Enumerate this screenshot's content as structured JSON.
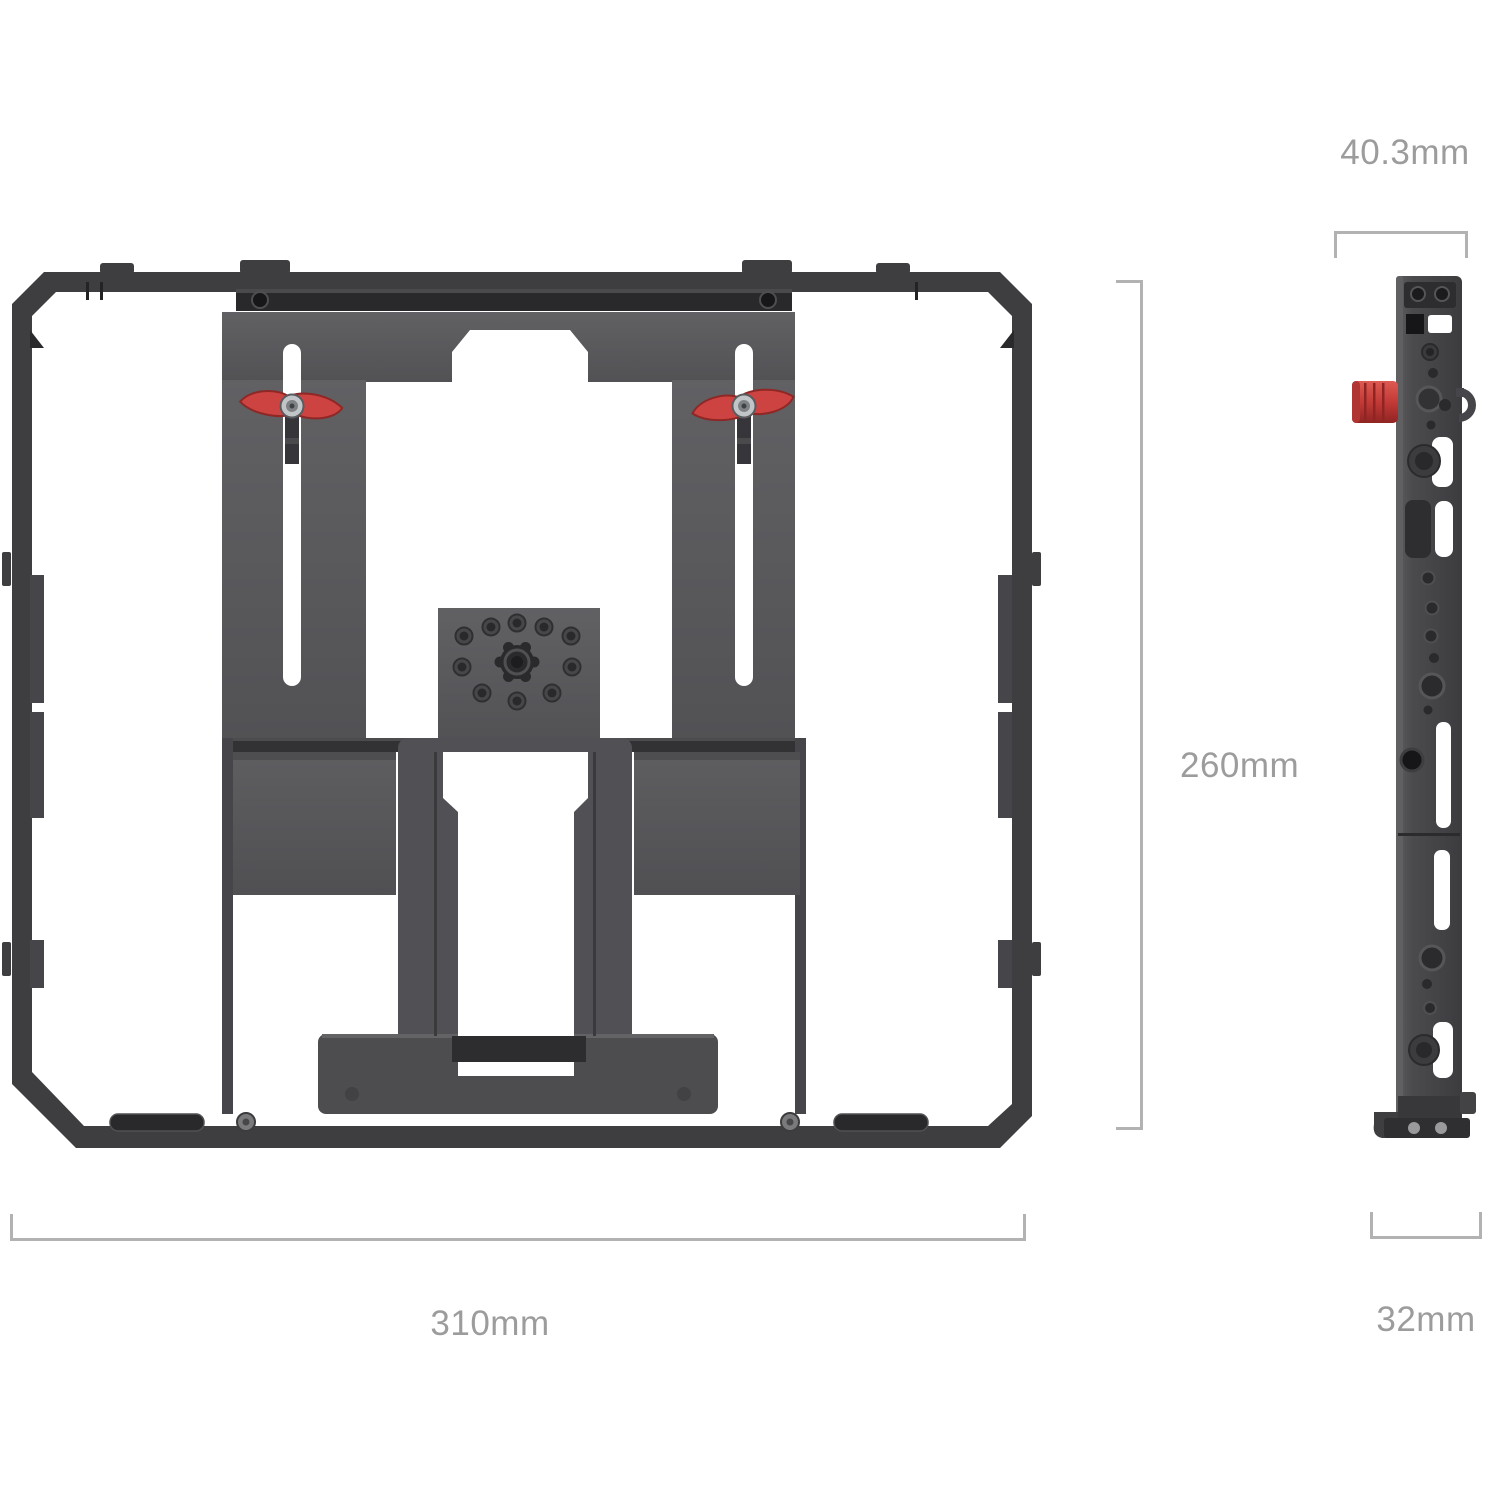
{
  "diagram": {
    "dimensions": {
      "front_width": "310mm",
      "front_height": "260mm",
      "side_top_width": "40.3mm",
      "side_bottom_width": "32mm"
    },
    "colors": {
      "background": "#ffffff",
      "cage_frame": "#3e3e41",
      "plate_gray": "#59595c",
      "panel_gray": "#56565a",
      "accent_red": "#cd4341",
      "knob_red": "#b23431",
      "dimension_line": "#b2b2b2",
      "dimension_text": "#9c9c9c"
    }
  }
}
